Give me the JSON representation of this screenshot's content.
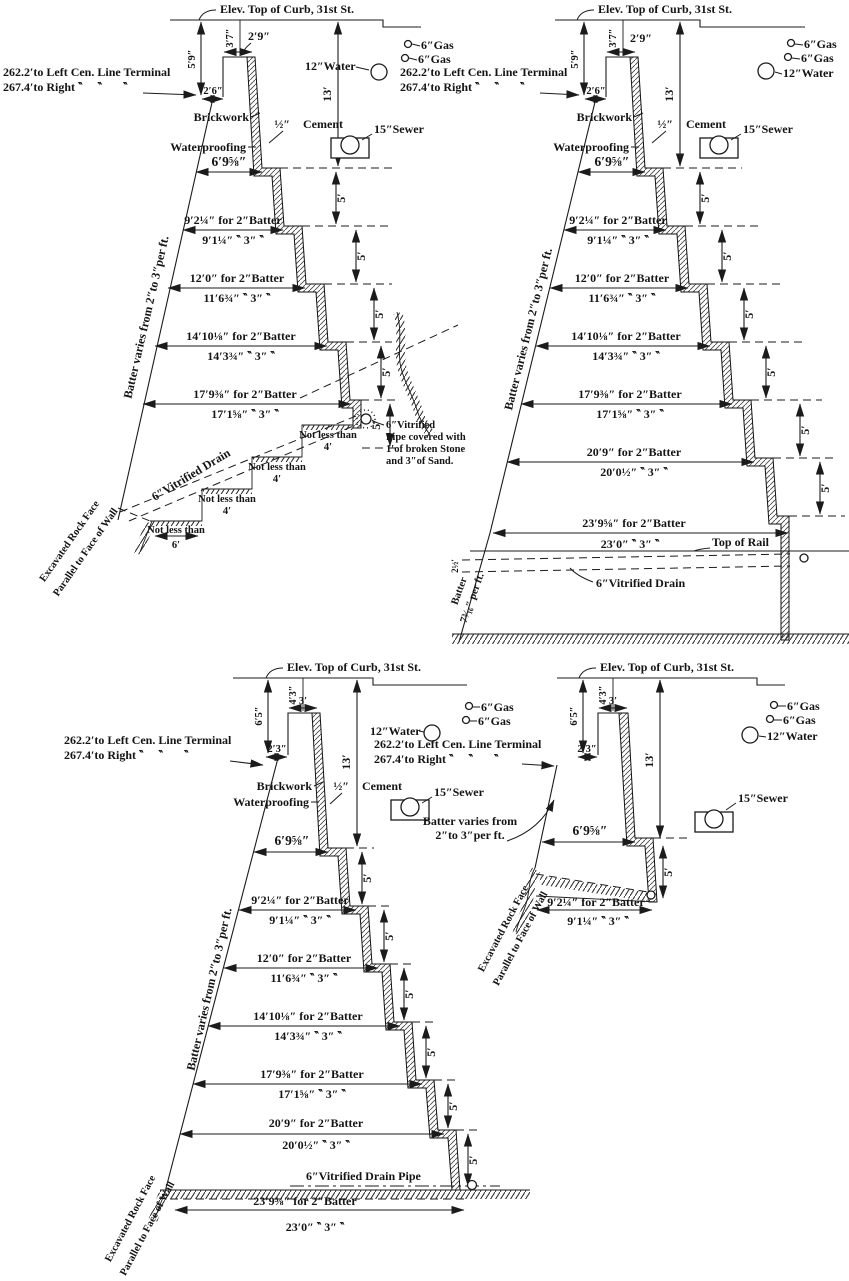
{
  "shared": {
    "curb_label": "Elev. Top of Curb, 31st St.",
    "terminal_line1": "262.2′to Left Cen. Line Terminal",
    "terminal_line2": "267.4′to Right ‶     ‶       ‶",
    "brickwork": "Brickwork",
    "waterproofing": "Waterproofing",
    "cement_thickness": "½″",
    "cement": "Cement",
    "top_width": "6′9⅝″",
    "batter_note": "Batter varies from 2″to 3″per ft.",
    "five_feet": "5′",
    "thirteen_feet": "13′",
    "gas_label": "6″Gas",
    "water_label": "12″Water",
    "sewer_label": "15″Sewer",
    "rock_face_line1": "Excavated Rock Face",
    "rock_face_line2": "Parallel to Face of Wall",
    "batter_rows": [
      {
        "two": "9′2¼″ for 2″Batter",
        "three": "9′1¼″ ‶ 3″ ‶"
      },
      {
        "two": "12′0″ for 2″Batter",
        "three": "11′6¾″ ‶ 3″ ‶"
      },
      {
        "two": "14′10⅛″ for 2″Batter",
        "three": "14′3¾″ ‶ 3″ ‶"
      },
      {
        "two": "17′9⅜″ for 2″Batter",
        "three": "17′1⅝″ ‶ 3″ ‶"
      },
      {
        "two": "20′9″ for 2″Batter",
        "three": "20′0½″ ‶ 3″ ‶"
      },
      {
        "two": "23′9⅝″ for 2″Batter",
        "three": "23′0″ ‶ 3″ ‶"
      }
    ]
  },
  "section_a": {
    "dim_5_9": "5′9″",
    "dim_3_7": "3′7″",
    "dim_2_9": "2′9″",
    "dim_2_6": "2′6″",
    "not_less_than": "Not less than",
    "four_feet": "4′",
    "six_feet": "6′",
    "drain_label": "6″Vitrified Drain",
    "pipe_note_line1": "6″Vitrified",
    "pipe_note_line2": "Pipe covered with",
    "pipe_note_line3": "1′of broken Stone",
    "pipe_note_line4": "and 3″of Sand."
  },
  "section_b": {
    "dim_5_9": "5′9″",
    "dim_3_7": "3′7″",
    "dim_2_9": "2′9″",
    "dim_2_6": "2′6″",
    "top_of_rail": "Top of Rail",
    "drain_label": "6″Vitrified Drain",
    "batter_lower_line1": "Batter",
    "batter_lower_line2": "7³⁄₁₆″ per ft.",
    "dim_2_5": "2½′"
  },
  "section_c": {
    "dim_6_5": "6′5″",
    "dim_4_3": "4′3″",
    "dim_3": "3′",
    "dim_2_3": "2′3″",
    "drain_label": "6″Vitrified Drain Pipe"
  },
  "section_d": {
    "dim_6_5": "6′5″",
    "dim_4_3": "4′3″",
    "dim_3": "3′",
    "dim_2_3": "2′3″",
    "batter_note_line1": "Batter varies from",
    "batter_note_line2": "2″to 3″per ft."
  }
}
